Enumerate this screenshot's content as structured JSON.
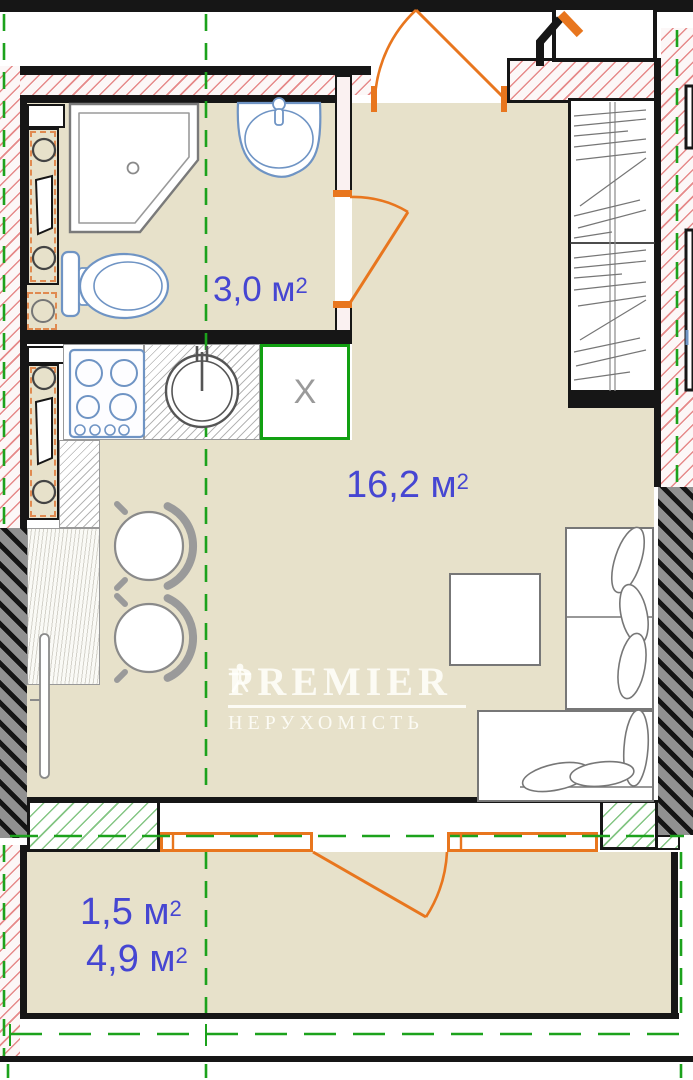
{
  "plan": {
    "title": "apartment floor plan",
    "watermark": {
      "brand": "PREMIER",
      "tagline": "НЕРУХОМІСТЬ"
    },
    "labels": {
      "bathroom": {
        "value": "3,0 м",
        "sup": "2"
      },
      "living_room": {
        "value": "16,2 м",
        "sup": "2"
      },
      "balcony_reduced": {
        "value": "1,5 м",
        "sup": "2"
      },
      "balcony_full": {
        "value": "4,9 м",
        "sup": "2"
      }
    },
    "markers": {
      "removed_unit": "X"
    },
    "colors": {
      "area_label_blue": "#4646d2",
      "door_window_orange": "#e8761e",
      "construction_green": "#1ca21c",
      "wall_hatch_red": "#e06e6e",
      "floor_beige": "#e7e1ca",
      "fixture_blue": "#6f94c4",
      "external_wall_gray": "#919191"
    }
  }
}
